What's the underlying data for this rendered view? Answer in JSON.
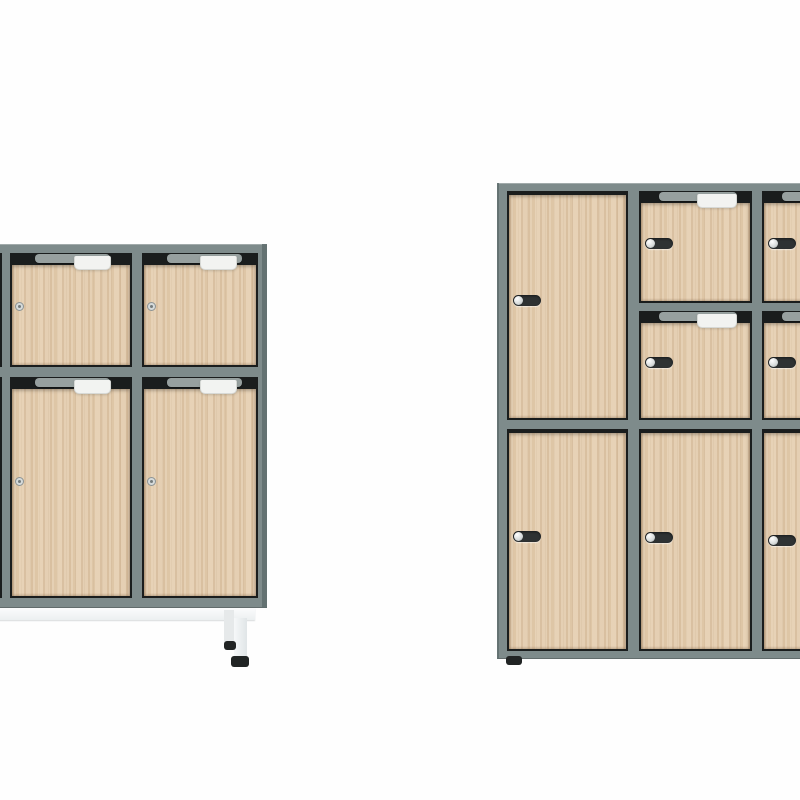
{
  "image": {
    "width": 800,
    "height": 800,
    "subject": "product photo of two office locker cabinets with light oak doors and grey steel frames on a white background",
    "text_content": "none"
  },
  "palette": {
    "bg": "#fefefe",
    "frame": "#7e8b8b",
    "frameDark": "#5f6d6d",
    "recess": "#1a1d1d",
    "strip": "#97a09f",
    "notch": "#f2f3f1",
    "notchBorder": "#d7d9d6",
    "wood": "#e2cbad",
    "lockPill": "#2e3233",
    "lockKnob": "#d6dada",
    "lockRoundFill": "#d5dada",
    "lockRoundRing": "#8c9394",
    "lockRoundDot": "#747b7c",
    "footDark": "#212424"
  },
  "cabinets": [
    {
      "id": "left-locker-on-legs",
      "frame": {
        "x": -121,
        "y": 244,
        "w": 388,
        "h": 364
      },
      "edge_shades": [
        {
          "x": 262,
          "y": 244,
          "w": 5,
          "h": 364
        }
      ],
      "doors": [
        {
          "x": -112,
          "y": 253,
          "w": 114,
          "h": 114,
          "top": "band",
          "strip": {
            "dx": 25,
            "w": 75
          },
          "notch": {
            "right": 21,
            "w": 37
          },
          "lock": {
            "type": "round",
            "cx": 10,
            "cy": 54
          }
        },
        {
          "x": 10,
          "y": 253,
          "w": 122,
          "h": 114,
          "top": "band",
          "strip": {
            "dx": 25,
            "w": 75
          },
          "notch": {
            "right": 21,
            "w": 37
          },
          "lock": {
            "type": "round",
            "cx": 10,
            "cy": 54
          }
        },
        {
          "x": 142,
          "y": 253,
          "w": 116,
          "h": 114,
          "top": "band",
          "strip": {
            "dx": 25,
            "w": 75
          },
          "notch": {
            "right": 21,
            "w": 37
          },
          "lock": {
            "type": "round",
            "cx": 10,
            "cy": 54
          }
        },
        {
          "x": -112,
          "y": 377,
          "w": 114,
          "h": 221,
          "top": "band",
          "strip": {
            "dx": 25,
            "w": 75
          },
          "notch": {
            "right": 21,
            "w": 37
          },
          "lock": {
            "type": "round",
            "cx": 10,
            "cy": 105
          }
        },
        {
          "x": 10,
          "y": 377,
          "w": 122,
          "h": 221,
          "top": "band",
          "strip": {
            "dx": 25,
            "w": 75
          },
          "notch": {
            "right": 21,
            "w": 37
          },
          "lock": {
            "type": "round",
            "cx": 10,
            "cy": 105
          }
        },
        {
          "x": 142,
          "y": 377,
          "w": 116,
          "h": 221,
          "top": "band",
          "strip": {
            "dx": 25,
            "w": 75
          },
          "notch": {
            "right": 21,
            "w": 37
          },
          "lock": {
            "type": "round",
            "cx": 10,
            "cy": 105
          }
        }
      ],
      "legs": {
        "bar": {
          "x": -121,
          "y": 608,
          "w": 376,
          "h": 12
        },
        "uprights": [
          {
            "x": 224,
            "y": 610,
            "w": 10,
            "h": 34,
            "shade": "rear"
          },
          {
            "x": 234,
            "y": 618,
            "w": 13,
            "h": 41,
            "shade": "front"
          }
        ],
        "feet": [
          {
            "x": 224,
            "y": 641,
            "w": 12,
            "h": 9
          },
          {
            "x": 231,
            "y": 656,
            "w": 18,
            "h": 11
          }
        ]
      }
    },
    {
      "id": "right-locker",
      "frame": {
        "x": 497,
        "y": 183,
        "w": 388,
        "h": 476
      },
      "edge_shades": [
        {
          "x": 497,
          "y": 183,
          "w": 2,
          "h": 476
        }
      ],
      "doors": [
        {
          "x": 507,
          "y": 191,
          "w": 121,
          "h": 229,
          "top": "thin",
          "lock": {
            "type": "pill",
            "dx": 6,
            "cy": 110
          }
        },
        {
          "x": 639,
          "y": 191,
          "w": 113,
          "h": 112,
          "top": "band",
          "strip": {
            "dx": 20,
            "w": 78
          },
          "notch": {
            "right": 15,
            "w": 40
          },
          "lock": {
            "type": "pill",
            "dx": 6,
            "cy": 53
          }
        },
        {
          "x": 762,
          "y": 191,
          "w": 113,
          "h": 112,
          "top": "band",
          "strip": {
            "dx": 20,
            "w": 78
          },
          "notch": {
            "right": 15,
            "w": 40
          },
          "lock": {
            "type": "pill",
            "dx": 6,
            "cy": 53
          }
        },
        {
          "x": 639,
          "y": 311,
          "w": 113,
          "h": 109,
          "top": "band",
          "strip": {
            "dx": 20,
            "w": 78
          },
          "notch": {
            "right": 15,
            "w": 40
          },
          "lock": {
            "type": "pill",
            "dx": 6,
            "cy": 52
          }
        },
        {
          "x": 762,
          "y": 311,
          "w": 113,
          "h": 109,
          "top": "band",
          "strip": {
            "dx": 20,
            "w": 78
          },
          "notch": {
            "right": 15,
            "w": 40
          },
          "lock": {
            "type": "pill",
            "dx": 6,
            "cy": 52
          }
        },
        {
          "x": 507,
          "y": 429,
          "w": 121,
          "h": 222,
          "top": "thin",
          "lock": {
            "type": "pill",
            "dx": 6,
            "cy": 108
          }
        },
        {
          "x": 639,
          "y": 429,
          "w": 113,
          "h": 222,
          "top": "thin",
          "lock": {
            "type": "pill",
            "dx": 6,
            "cy": 109
          }
        },
        {
          "x": 762,
          "y": 429,
          "w": 113,
          "h": 222,
          "top": "thin",
          "lock": {
            "type": "pill",
            "dx": 6,
            "cy": 112
          }
        }
      ],
      "feet": [
        {
          "x": 506,
          "y": 656,
          "w": 16,
          "h": 9
        }
      ]
    }
  ],
  "construction": {
    "band_height_px": 12,
    "thin_band_height_px": 4,
    "wood_side_inset_px": 2,
    "pill_lock": {
      "w": 28,
      "h": 11
    },
    "round_lock": {
      "d": 9
    },
    "notch_h": 14,
    "strip_h": 9
  }
}
